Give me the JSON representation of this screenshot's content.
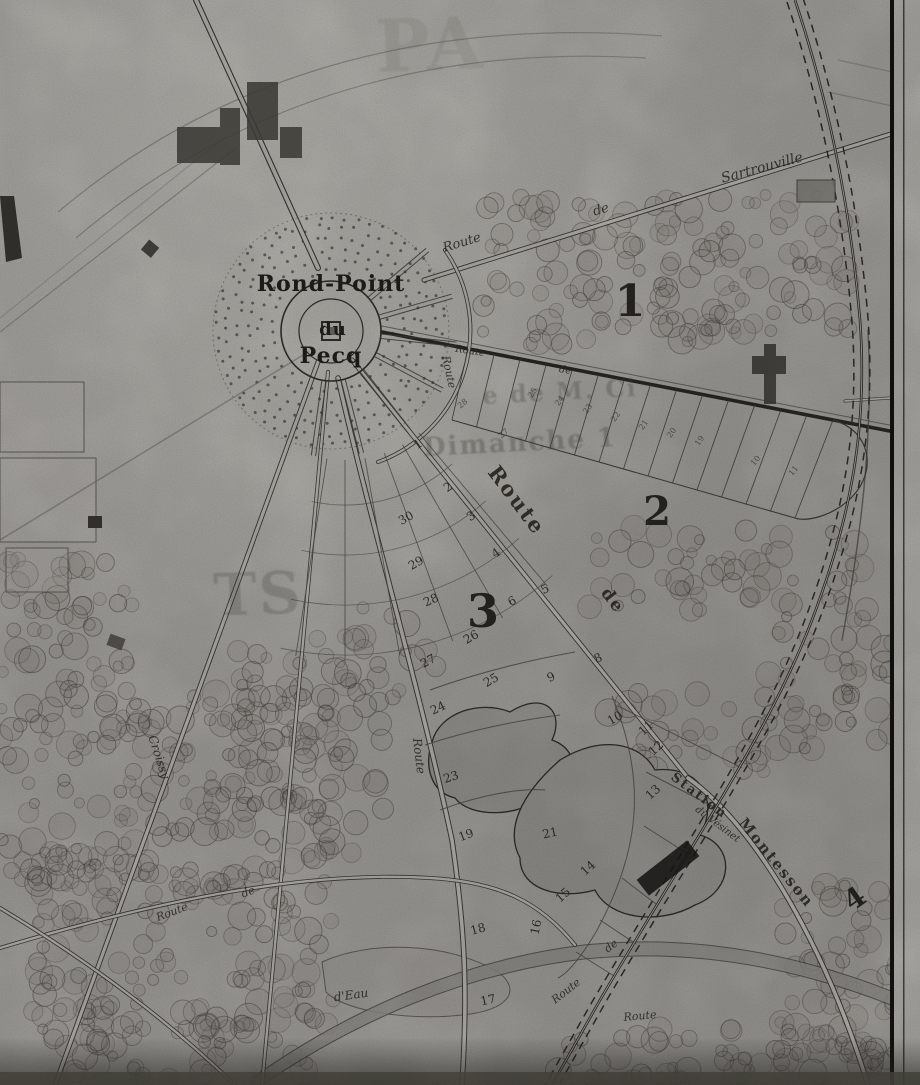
{
  "map": {
    "kind": "historical-cadastral-map-photograph",
    "colors": {
      "paper": "#b4b2ad",
      "ink": "#35332f",
      "road_fill": "#c6c4be",
      "pond": "#a3a19c",
      "station_building": "#1c1b19",
      "bottom_shadow": "#5a5853"
    },
    "center_labels": [
      {
        "text": "Rond-Point",
        "x": 331,
        "y": 284,
        "size": 22,
        "rot": 0
      },
      {
        "text": "du",
        "x": 333,
        "y": 330,
        "size": 18,
        "rot": 0
      },
      {
        "text": "Pecq",
        "x": 331,
        "y": 356,
        "size": 22,
        "rot": 0
      }
    ],
    "road_labels": [
      {
        "text": "Route",
        "x": 462,
        "y": 243,
        "rot": -17,
        "size": 13
      },
      {
        "text": "de",
        "x": 601,
        "y": 210,
        "rot": -16,
        "size": 13
      },
      {
        "text": "Sartrouville",
        "x": 762,
        "y": 168,
        "rot": -15,
        "size": 14
      },
      {
        "text": "Route",
        "x": 470,
        "y": 352,
        "rot": 9,
        "size": 10
      },
      {
        "text": "de",
        "x": 565,
        "y": 371,
        "rot": 10,
        "size": 10
      },
      {
        "text": "Route",
        "x": 449,
        "y": 372,
        "rot": 78,
        "size": 11
      },
      {
        "text": "Route",
        "x": 517,
        "y": 500,
        "rot": 53,
        "size": 21,
        "b": 1
      },
      {
        "text": "de",
        "x": 612,
        "y": 601,
        "rot": 53,
        "size": 17,
        "b": 1
      },
      {
        "text": "Croissy",
        "x": 159,
        "y": 757,
        "rot": 72,
        "size": 12
      },
      {
        "text": "Route",
        "x": 419,
        "y": 756,
        "rot": 83,
        "size": 12
      },
      {
        "text": "Montesson",
        "x": 776,
        "y": 863,
        "rot": 51,
        "size": 15,
        "b": 1
      },
      {
        "text": "Station",
        "x": 699,
        "y": 796,
        "rot": 37,
        "size": 13,
        "b": 1
      },
      {
        "text": "du Vésinet",
        "x": 717,
        "y": 825,
        "rot": 37,
        "size": 10
      },
      {
        "text": "Route",
        "x": 566,
        "y": 991,
        "rot": -38,
        "size": 11
      },
      {
        "text": "de",
        "x": 611,
        "y": 946,
        "rot": -38,
        "size": 11
      },
      {
        "text": "Route",
        "x": 172,
        "y": 912,
        "rot": -21,
        "size": 11
      },
      {
        "text": "de",
        "x": 248,
        "y": 892,
        "rot": -21,
        "size": 11
      },
      {
        "text": "d'Eau",
        "x": 351,
        "y": 995,
        "rot": -8,
        "size": 12
      },
      {
        "text": "Route",
        "x": 640,
        "y": 1016,
        "rot": -5,
        "size": 11
      }
    ],
    "district_numbers": [
      {
        "text": "1",
        "x": 630,
        "y": 302,
        "size": 44,
        "rot": 0
      },
      {
        "text": "2",
        "x": 657,
        "y": 512,
        "size": 40,
        "rot": 0
      },
      {
        "text": "3",
        "x": 483,
        "y": 611,
        "size": 46,
        "rot": 0
      },
      {
        "text": "4",
        "x": 855,
        "y": 899,
        "size": 28,
        "rot": -35
      }
    ],
    "parcel_numbers": [
      {
        "text": "1",
        "x": 418,
        "y": 444,
        "rot": -35
      },
      {
        "text": "2",
        "x": 448,
        "y": 487,
        "rot": -35
      },
      {
        "text": "3",
        "x": 471,
        "y": 516,
        "rot": -35
      },
      {
        "text": "4",
        "x": 496,
        "y": 553,
        "rot": -35
      },
      {
        "text": "5",
        "x": 545,
        "y": 589,
        "rot": -28
      },
      {
        "text": "6",
        "x": 512,
        "y": 601,
        "rot": -28
      },
      {
        "text": "8",
        "x": 598,
        "y": 658,
        "rot": -25
      },
      {
        "text": "9",
        "x": 551,
        "y": 677,
        "rot": -25
      },
      {
        "text": "10",
        "x": 615,
        "y": 718,
        "rot": -30
      },
      {
        "text": "11",
        "x": 646,
        "y": 728,
        "rot": -42
      },
      {
        "text": "12",
        "x": 656,
        "y": 748,
        "rot": -42
      },
      {
        "text": "13",
        "x": 653,
        "y": 792,
        "rot": -42
      },
      {
        "text": "14",
        "x": 588,
        "y": 868,
        "rot": -42
      },
      {
        "text": "15",
        "x": 563,
        "y": 895,
        "rot": -42
      },
      {
        "text": "16",
        "x": 536,
        "y": 927,
        "rot": -78
      },
      {
        "text": "17",
        "x": 488,
        "y": 1000,
        "rot": -12
      },
      {
        "text": "18",
        "x": 478,
        "y": 929,
        "rot": -15
      },
      {
        "text": "19",
        "x": 466,
        "y": 835,
        "rot": -20
      },
      {
        "text": "21",
        "x": 550,
        "y": 833,
        "rot": -12
      },
      {
        "text": "23",
        "x": 451,
        "y": 777,
        "rot": -18
      },
      {
        "text": "24",
        "x": 438,
        "y": 708,
        "rot": -25
      },
      {
        "text": "25",
        "x": 491,
        "y": 680,
        "rot": -30
      },
      {
        "text": "26",
        "x": 471,
        "y": 637,
        "rot": -30
      },
      {
        "text": "27",
        "x": 428,
        "y": 661,
        "rot": -28
      },
      {
        "text": "28",
        "x": 431,
        "y": 600,
        "rot": -24
      },
      {
        "text": "29",
        "x": 416,
        "y": 563,
        "rot": -30
      },
      {
        "text": "30",
        "x": 406,
        "y": 518,
        "rot": -30
      }
    ],
    "fan_strip_numbers": [
      {
        "text": "28",
        "x": 463,
        "y": 404,
        "rot": -40
      },
      {
        "text": "27",
        "x": 504,
        "y": 434,
        "rot": -40
      },
      {
        "text": "25",
        "x": 533,
        "y": 393,
        "rot": -55
      },
      {
        "text": "24",
        "x": 560,
        "y": 401,
        "rot": -55
      },
      {
        "text": "23",
        "x": 588,
        "y": 409,
        "rot": -55
      },
      {
        "text": "22",
        "x": 616,
        "y": 417,
        "rot": -55
      },
      {
        "text": "21",
        "x": 644,
        "y": 425,
        "rot": -55
      },
      {
        "text": "20",
        "x": 672,
        "y": 433,
        "rot": -55
      },
      {
        "text": "19",
        "x": 700,
        "y": 441,
        "rot": -55
      },
      {
        "text": "10",
        "x": 756,
        "y": 461,
        "rot": -50
      },
      {
        "text": "11",
        "x": 794,
        "y": 471,
        "rot": -50
      }
    ],
    "ghost_bleedthrough_text": [
      {
        "text": "PA",
        "x": 430,
        "y": 45,
        "size": 72,
        "op": 0.1,
        "rot": -2
      },
      {
        "text": "e de M. Ci",
        "x": 560,
        "y": 392,
        "size": 24,
        "op": 0.3,
        "rot": -3
      },
      {
        "text": "Dimanche 1",
        "x": 520,
        "y": 443,
        "size": 26,
        "op": 0.33,
        "rot": -3
      },
      {
        "text": "TS",
        "x": 258,
        "y": 594,
        "size": 58,
        "op": 0.24,
        "rot": -2
      }
    ]
  }
}
